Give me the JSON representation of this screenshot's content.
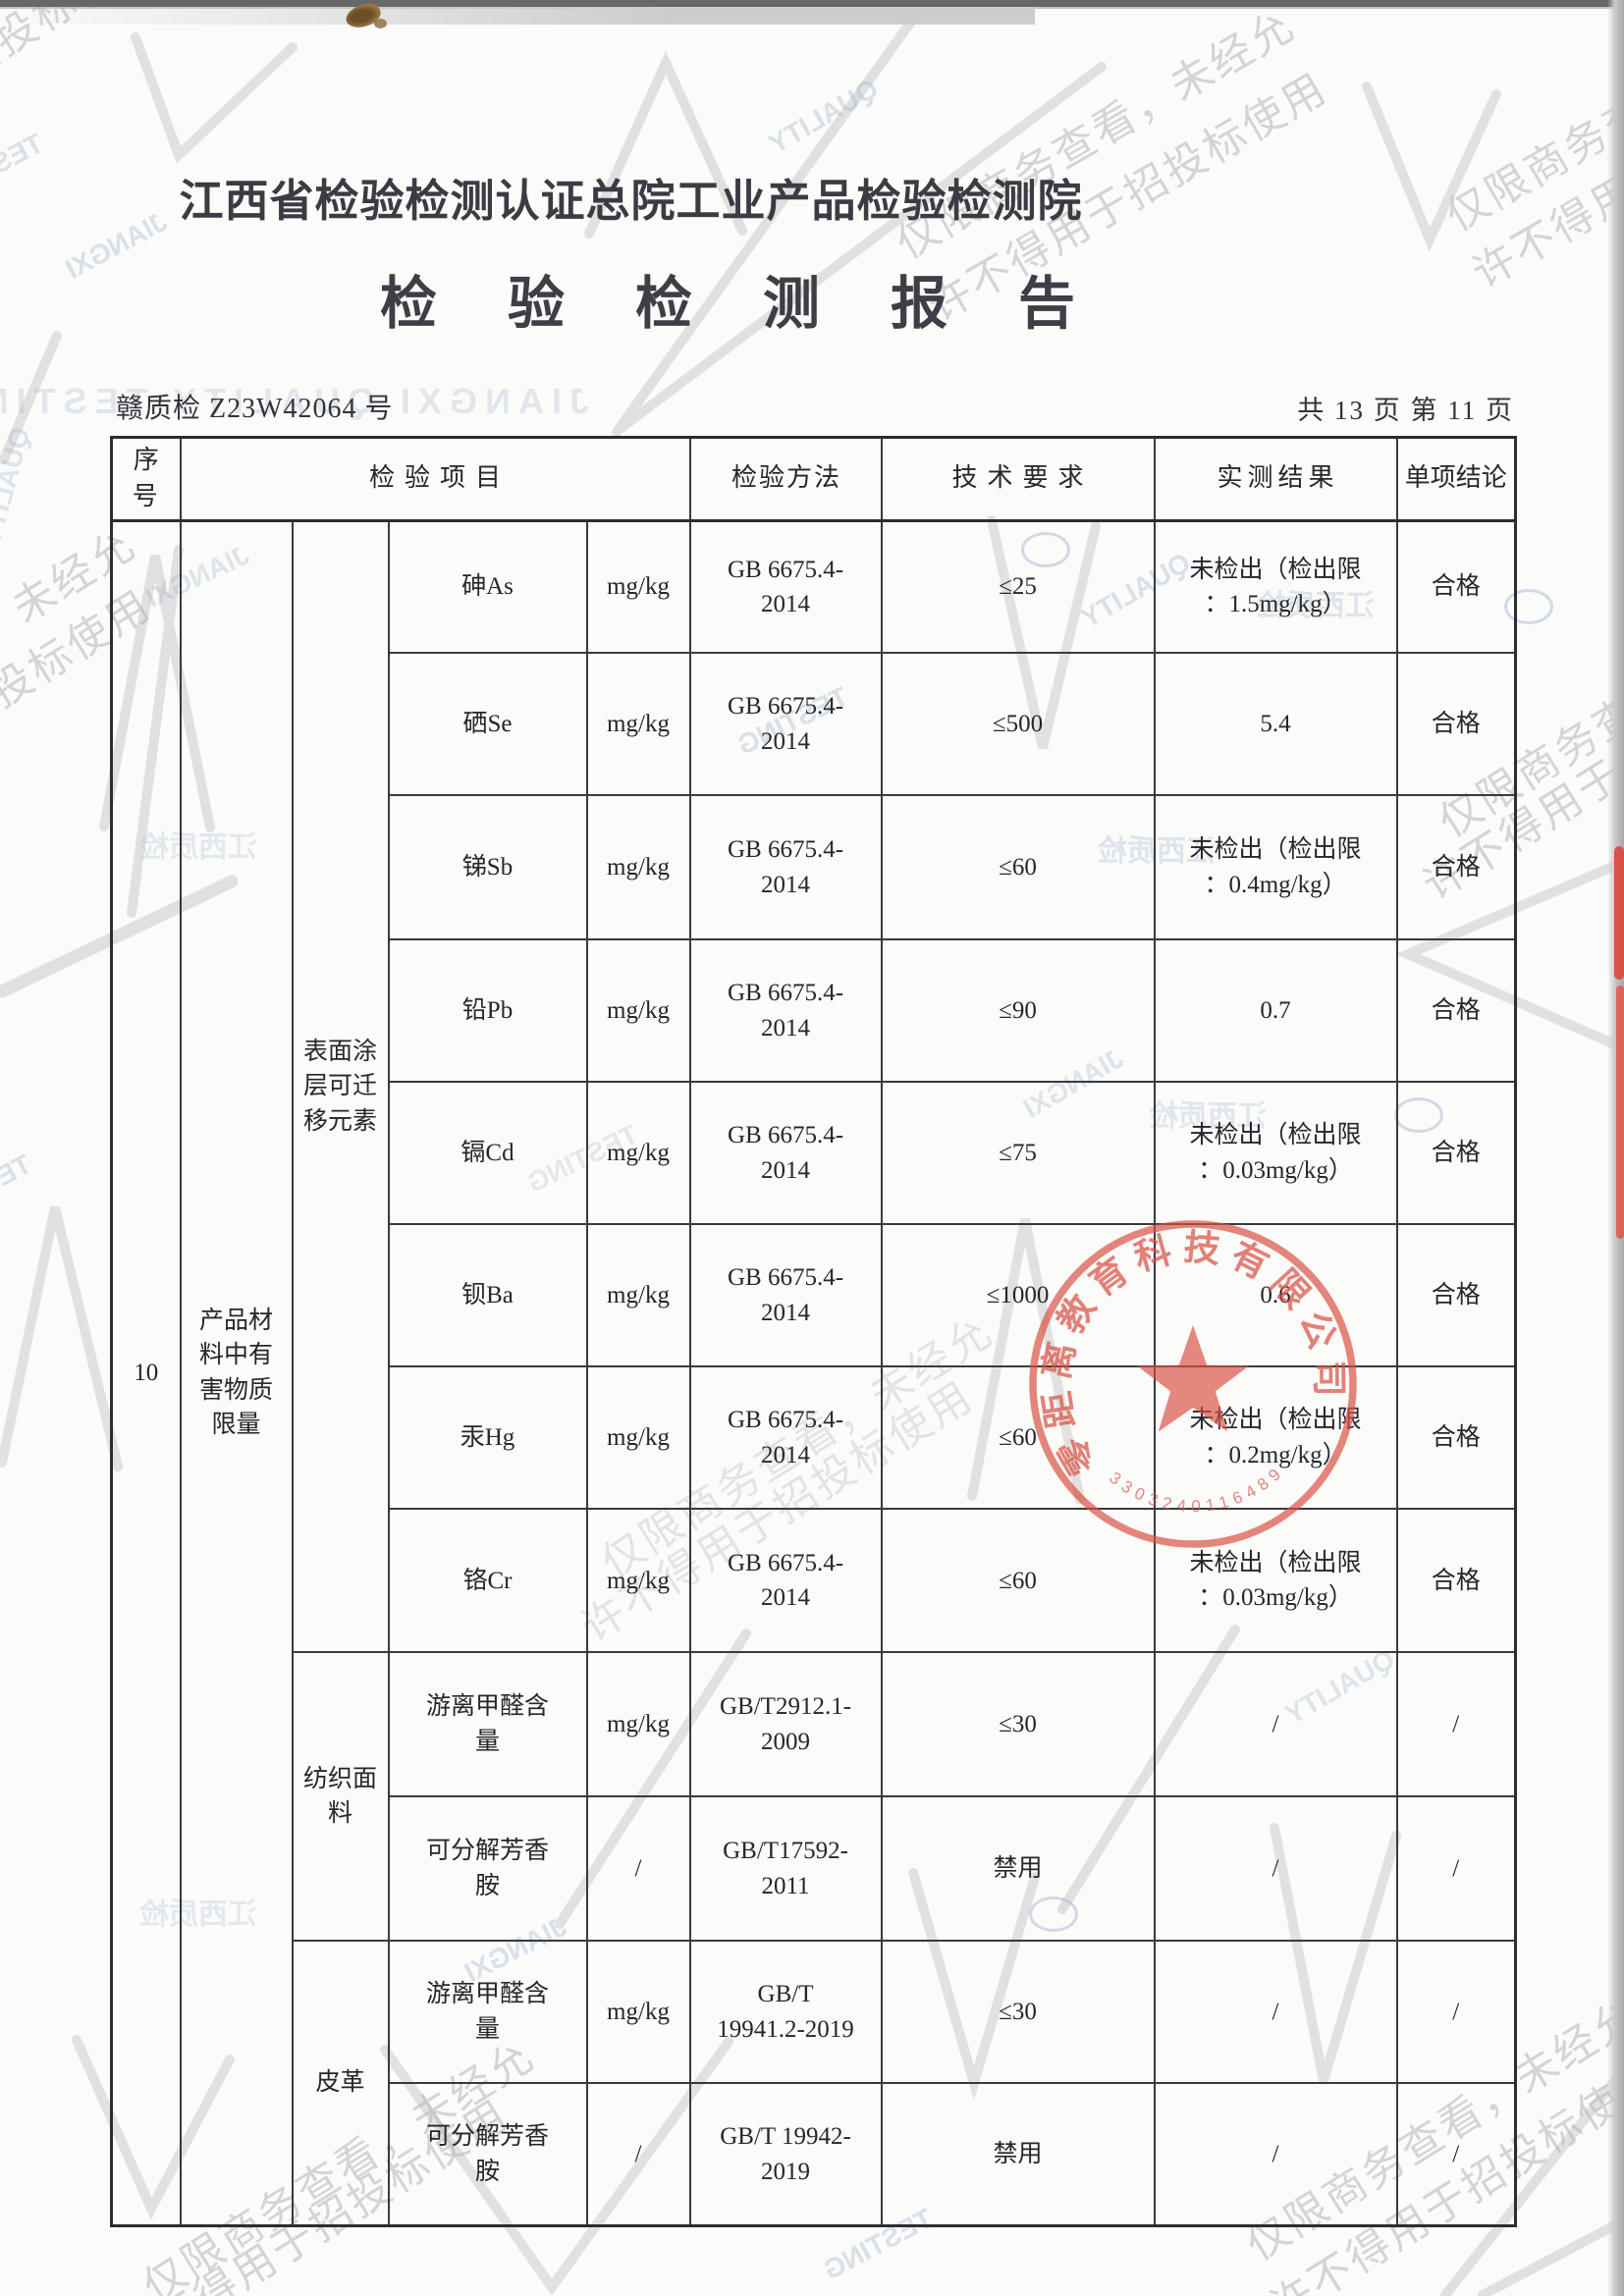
{
  "page": {
    "org_title": "江西省检验检测认证总院工业产品检验检测院",
    "report_title": "检验检测报告",
    "report_no": "赣质检 Z23W42064 号",
    "pagination": "共 13 页 第 11 页"
  },
  "table": {
    "headers": [
      "序号",
      "检验项目",
      "检验方法",
      "技术要求",
      "实测结果",
      "单项结论"
    ],
    "serial_no": "10",
    "category": "产品材\n料中有\n害物质\n限量",
    "groups": {
      "coating": "表面涂\n层可迁\n移元素",
      "textile": "纺织面\n料",
      "leather": "皮革"
    },
    "rows": [
      {
        "item": "砷As",
        "unit": "mg/kg",
        "method": "GB 6675.4-\n2014",
        "requirement": "≤25",
        "result": "未检出（检出限\n：1.5mg/kg）",
        "conclusion": "合格"
      },
      {
        "item": "硒Se",
        "unit": "mg/kg",
        "method": "GB 6675.4-\n2014",
        "requirement": "≤500",
        "result": "5.4",
        "conclusion": "合格"
      },
      {
        "item": "锑Sb",
        "unit": "mg/kg",
        "method": "GB 6675.4-\n2014",
        "requirement": "≤60",
        "result": "未检出（检出限\n：0.4mg/kg）",
        "conclusion": "合格"
      },
      {
        "item": "铅Pb",
        "unit": "mg/kg",
        "method": "GB 6675.4-\n2014",
        "requirement": "≤90",
        "result": "0.7",
        "conclusion": "合格"
      },
      {
        "item": "镉Cd",
        "unit": "mg/kg",
        "method": "GB 6675.4-\n2014",
        "requirement": "≤75",
        "result": "未检出（检出限\n：0.03mg/kg）",
        "conclusion": "合格"
      },
      {
        "item": "钡Ba",
        "unit": "mg/kg",
        "method": "GB 6675.4-\n2014",
        "requirement": "≤1000",
        "result": "0.6",
        "conclusion": "合格"
      },
      {
        "item": "汞Hg",
        "unit": "mg/kg",
        "method": "GB 6675.4-\n2014",
        "requirement": "≤60",
        "result": "未检出（检出限\n：0.2mg/kg）",
        "conclusion": "合格"
      },
      {
        "item": "铬Cr",
        "unit": "mg/kg",
        "method": "GB 6675.4-\n2014",
        "requirement": "≤60",
        "result": "未检出（检出限\n：0.03mg/kg）",
        "conclusion": "合格"
      },
      {
        "item": "游离甲醛含\n量",
        "unit": "mg/kg",
        "method": "GB/T2912.1-\n2009",
        "requirement": "≤30",
        "result": "/",
        "conclusion": "/"
      },
      {
        "item": "可分解芳香\n胺",
        "unit": "/",
        "method": "GB/T17592-\n2011",
        "requirement": "禁用",
        "result": "/",
        "conclusion": "/"
      },
      {
        "item": "游离甲醛含\n量",
        "unit": "mg/kg",
        "method": "GB/T\n19941.2-2019",
        "requirement": "≤30",
        "result": "/",
        "conclusion": "/"
      },
      {
        "item": "可分解芳香\n胺",
        "unit": "/",
        "method": "GB/T 19942-\n2019",
        "requirement": "禁用",
        "result": "/",
        "conclusion": "/"
      }
    ]
  },
  "stamp": {
    "company": "零距离教育科技有限公司",
    "number": "3303240116489",
    "color": "#d94f42"
  },
  "watermark": {
    "line1": "仅限商务查看，未经允",
    "line2": "许不得用于招投标使用"
  },
  "ghost": {
    "phrase": "JIANGXI QUALITY TESTING",
    "word1": "JIANGXI",
    "word2": "QUALITY",
    "word3": "TESTING",
    "cn": "江西质检"
  }
}
